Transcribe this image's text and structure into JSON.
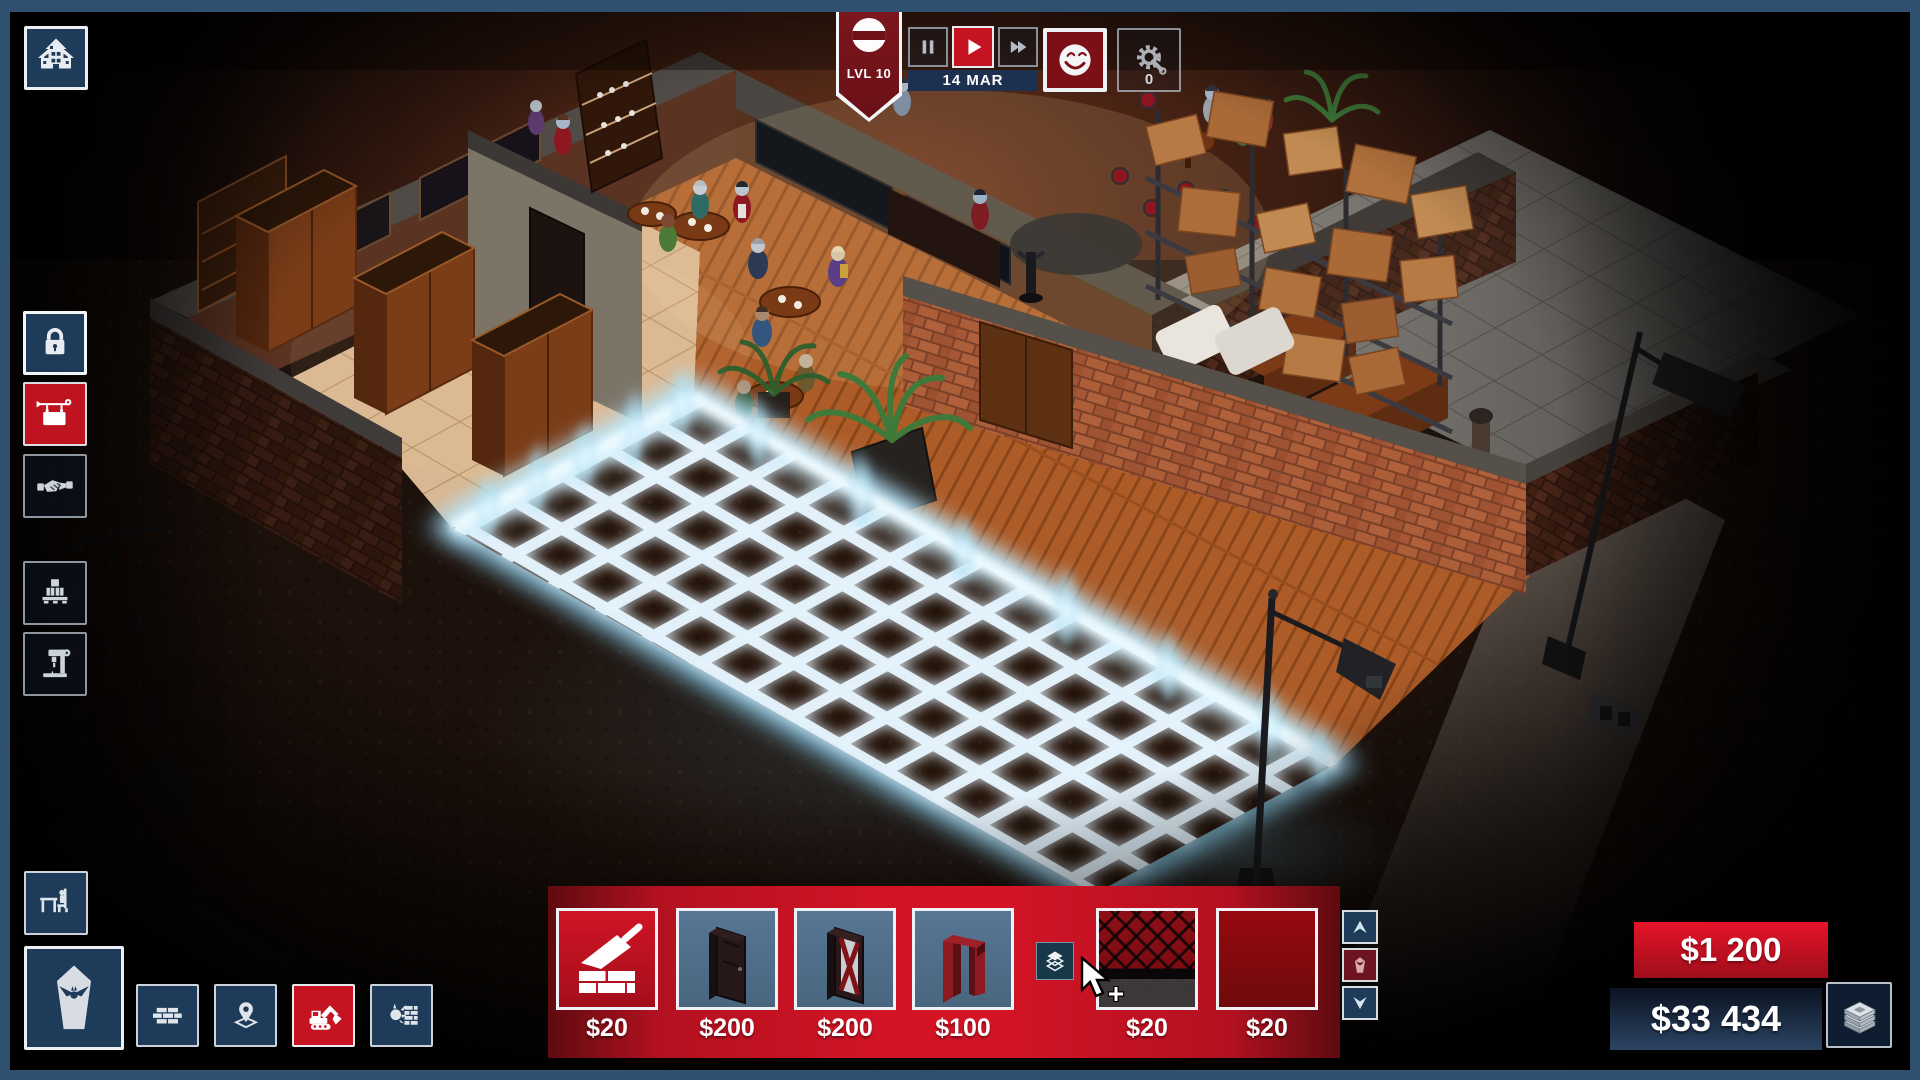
{
  "theme": {
    "frame": "#30506f",
    "accent-red": "#c51322",
    "deep-red": "#761219",
    "panel-navy": "#1e3b59",
    "tile-slate": "#4f7090",
    "grid-glow": "#bfe9ff"
  },
  "hud": {
    "level_badge": {
      "label": "LVL 10",
      "icon": "vampire-face-icon"
    },
    "date": "14 MAR",
    "controls": [
      {
        "id": "pause",
        "icon": "pause-icon",
        "active": false
      },
      {
        "id": "play",
        "icon": "play-icon",
        "active": true
      },
      {
        "id": "fast-forward",
        "icon": "fast-forward-icon",
        "active": false
      }
    ],
    "mood_button": {
      "icon": "smiley-icon"
    },
    "alerts_button": {
      "icon": "gear-wrench-icon",
      "count": "0"
    }
  },
  "left_panel": {
    "estate_button": {
      "icon": "haunted-house-icon"
    },
    "items": [
      {
        "id": "security",
        "icon": "padlock-icon",
        "state": "highlighted"
      },
      {
        "id": "business-sign",
        "icon": "hanging-sign-icon",
        "state": "selected"
      },
      {
        "id": "deals",
        "icon": "handshake-icon",
        "state": "normal"
      },
      {
        "id": "supplies",
        "icon": "pallet-boxes-icon",
        "state": "normal"
      },
      {
        "id": "production",
        "icon": "drill-press-icon",
        "state": "normal"
      }
    ]
  },
  "bottom_left_panel": {
    "furniture_button": {
      "icon": "table-chair-icon"
    },
    "coffin_button": {
      "icon": "coffin-bat-icon"
    },
    "build_buttons": [
      {
        "id": "walls",
        "icon": "brick-wall-icon",
        "state": "normal"
      },
      {
        "id": "zones",
        "icon": "map-pin-icon",
        "state": "normal"
      },
      {
        "id": "excavate",
        "icon": "excavator-icon",
        "state": "selected"
      },
      {
        "id": "demolish",
        "icon": "wrecking-ball-icon",
        "state": "normal"
      }
    ]
  },
  "build_toolbar": {
    "items": [
      {
        "id": "brick-wall-build",
        "icon": "trowel-brick-icon",
        "price": "$20",
        "selected": true
      },
      {
        "id": "door-solid",
        "icon": "solid-door-sprite",
        "price": "$200",
        "selected": false
      },
      {
        "id": "door-glazed",
        "icon": "glazed-door-sprite",
        "price": "$200",
        "selected": false
      },
      {
        "id": "doorway",
        "icon": "doorway-sprite",
        "price": "$100",
        "selected": false
      },
      {
        "id": "carpet-argyle",
        "icon": "argyle-carpet-swatch",
        "price": "$20",
        "selected": false
      },
      {
        "id": "carpet-red",
        "icon": "red-carpet-swatch",
        "price": "$20",
        "selected": false
      }
    ],
    "layers_button": {
      "icon": "layers-icon"
    },
    "scroll_up": {
      "icon": "arrow-up-icon"
    },
    "category_button": {
      "icon": "coffin-small-icon"
    },
    "scroll_down": {
      "icon": "arrow-down-icon"
    }
  },
  "money_panel": {
    "income_popup": "$1 200",
    "balance": "$33 434",
    "cash_button": {
      "icon": "money-stack-icon"
    }
  },
  "scene": {
    "objects": [
      "vampire-bar-room",
      "storage-room-with-boxes",
      "wardrobe-room",
      "blue-build-grid",
      "street-lamps",
      "dirt-lot",
      "patrons",
      "palm-plants"
    ]
  }
}
